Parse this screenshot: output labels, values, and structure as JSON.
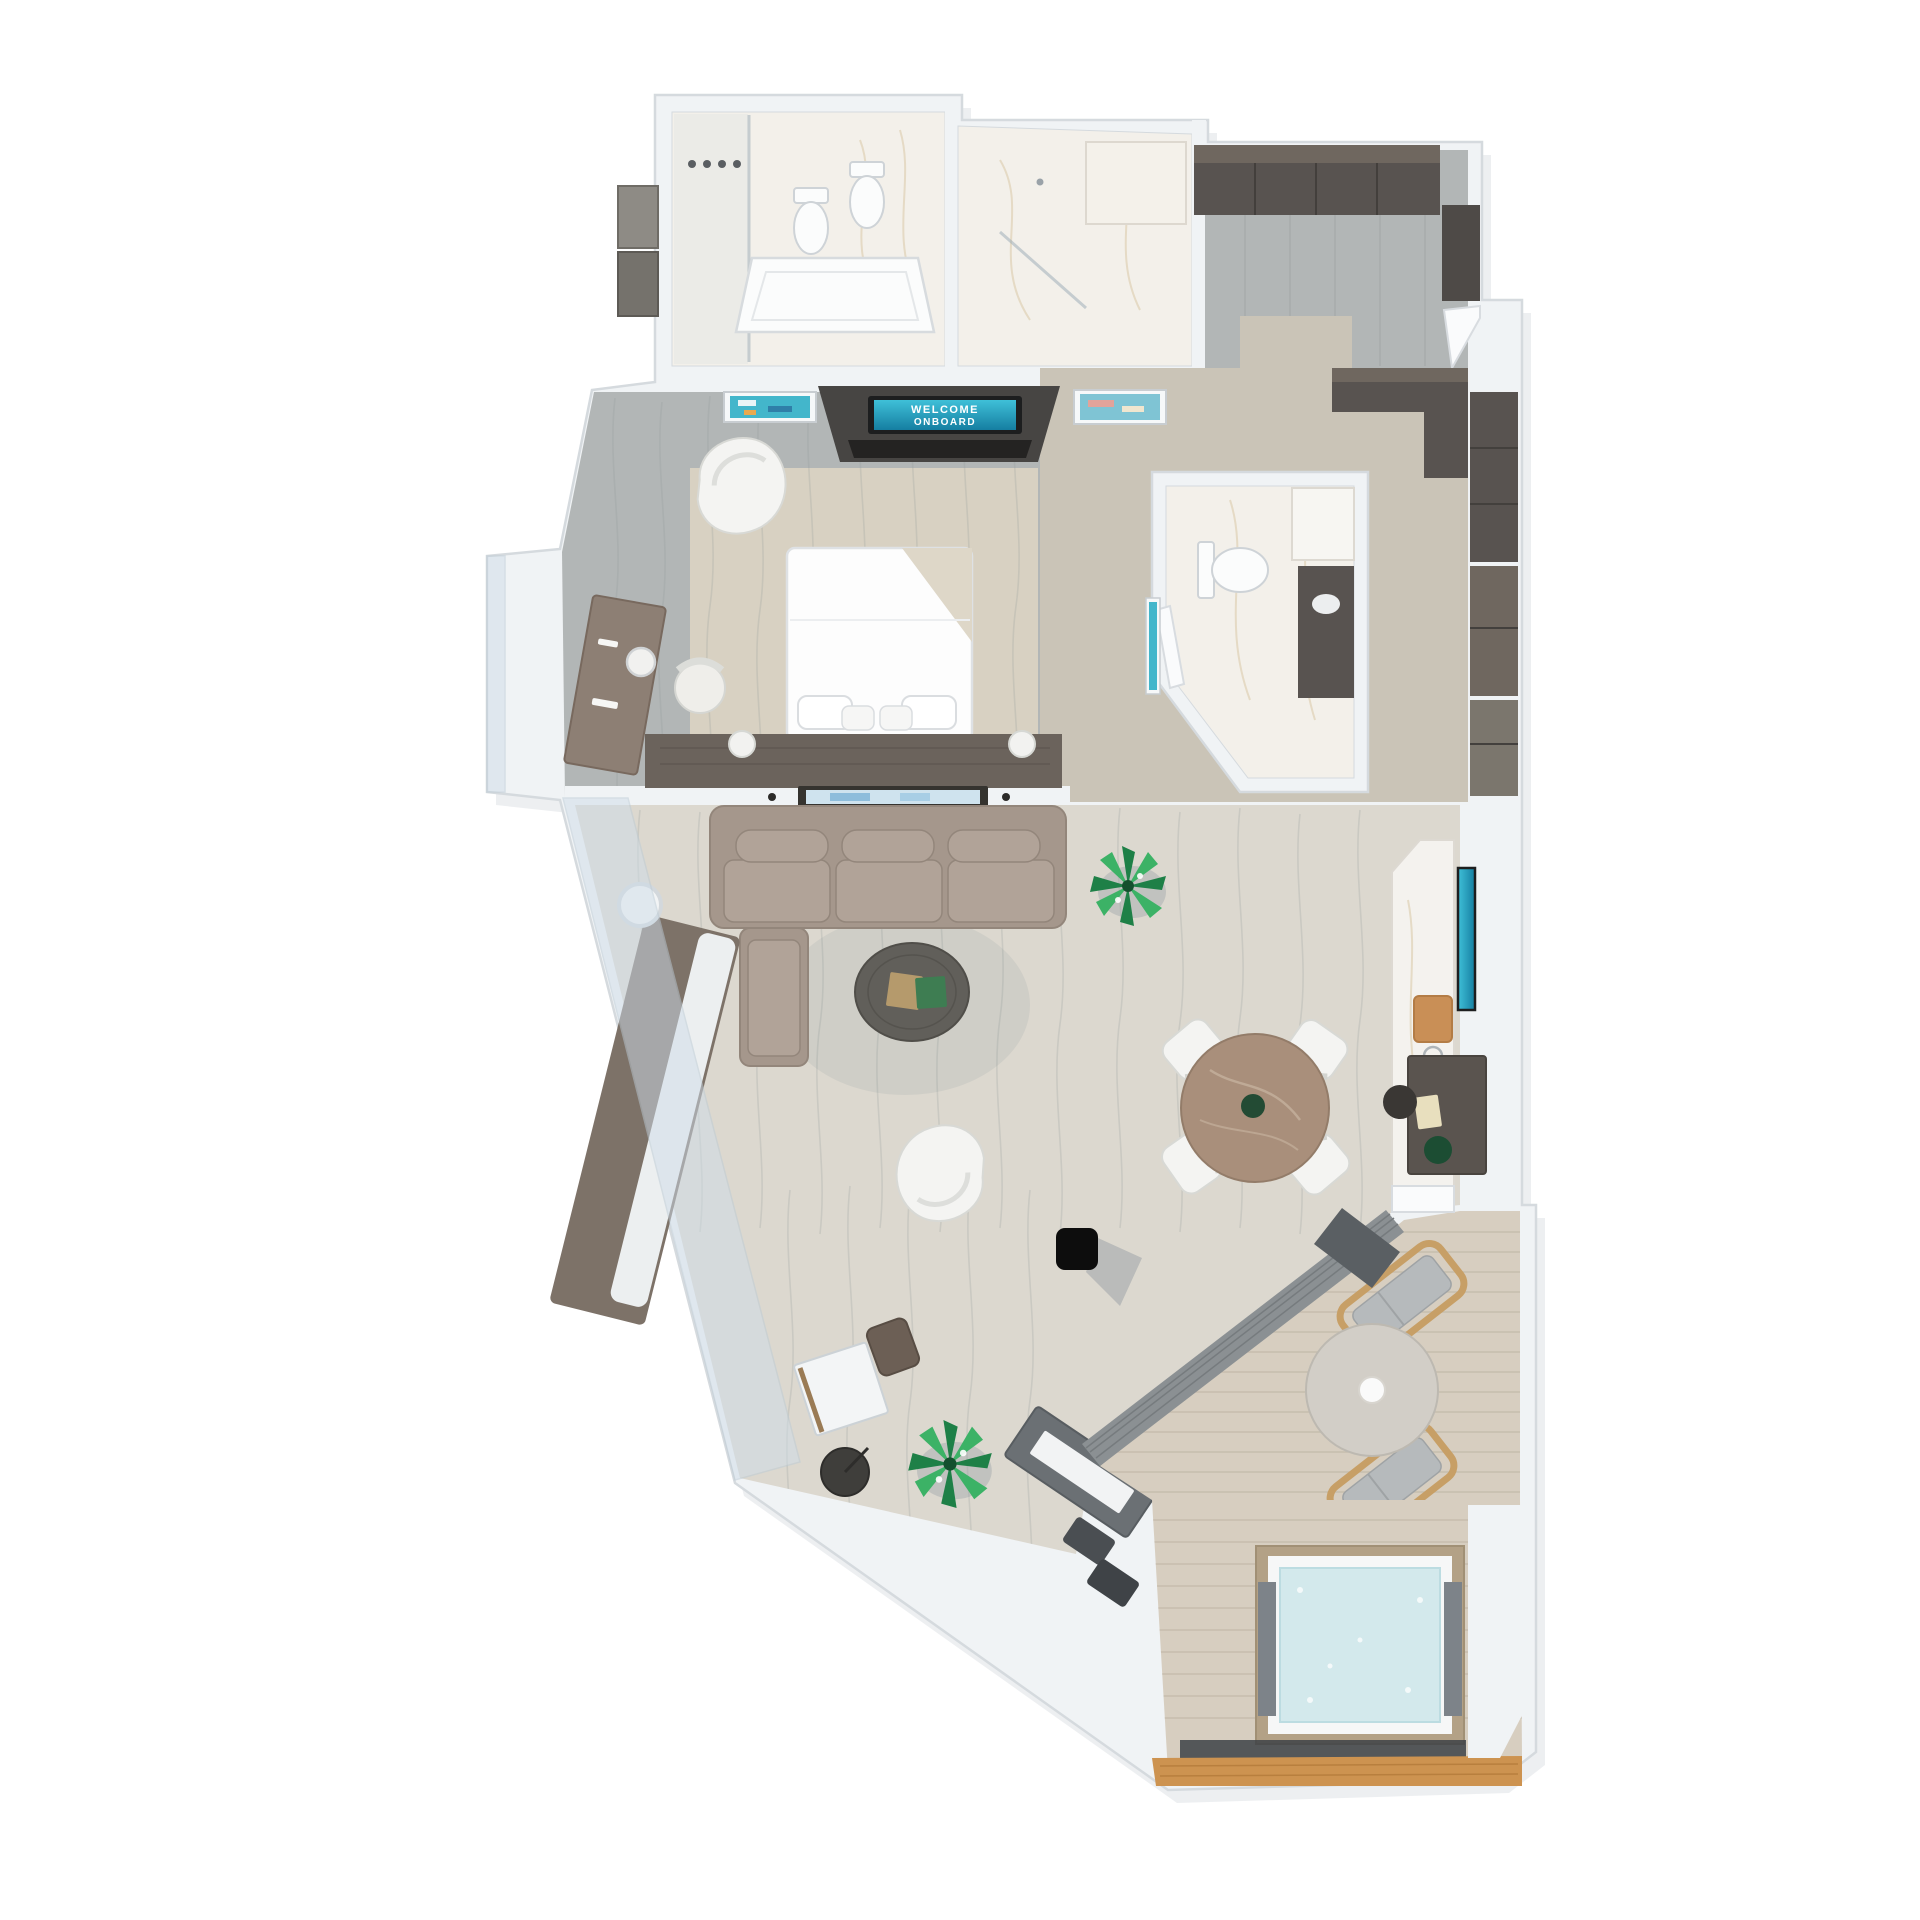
{
  "scene": {
    "type": "3d-floor-plan-top-down-render",
    "subject": "cruise-ship-suite-with-balcony-and-hot-tub",
    "tv_screen": {
      "line1": "WELCOME",
      "line2": "ONBOARD"
    },
    "rooms": [
      "master-bathroom",
      "walk-in-shower",
      "entry-hall",
      "wardrobe",
      "bedroom",
      "guest-bathroom",
      "hallway-closet",
      "living-room",
      "dining-area",
      "bar-counter",
      "balcony",
      "hot-tub-deck"
    ],
    "furniture": [
      "bathtub",
      "toilet",
      "bidet",
      "shower-heads",
      "vanity-cabinets",
      "king-bed",
      "pillows",
      "headboard",
      "bedroom-tv",
      "artworks",
      "organic-armchair",
      "vanity-desk",
      "desk-chair",
      "round-mirror",
      "sectional-sofa",
      "chaise",
      "coffee-table",
      "books",
      "floor-plants",
      "lounge-chair",
      "black-ottoman",
      "dining-table",
      "dining-chairs",
      "bar-tv",
      "cutting-board",
      "writing-desk",
      "side-table",
      "floor-lamp",
      "sideboard",
      "window-bench",
      "balcony-table",
      "sun-loungers",
      "hot-tub",
      "deck-planks"
    ]
  },
  "colors": {
    "bg": "#ffffff",
    "wall": "#f0f3f5",
    "wall-edge": "#d5dade",
    "wall-shadow": "#c2cad1",
    "marble": "#f3f0ea",
    "marble2": "#ece7df",
    "marble-vein": "#d9c8a6",
    "gray-wood-floor": "#b2b6b6",
    "beige-floor": "#cac4b7",
    "rug": "#d8d1c2",
    "living-floor": "#dcd8cf",
    "floor-line": "#8e9494",
    "wood-dark": "#585350",
    "wood-mid": "#6f675f",
    "headboard": "#6b635c",
    "sofa": "#a5978c",
    "sofa-cushion": "#b1a398",
    "sofa-edge": "#93867b",
    "white-furn": "#f4f4f2",
    "furn-edge": "#d8d9d5",
    "screen-teal": "#3fc0d8",
    "screen-teal-dark": "#157ea1",
    "art-teal": "#43b6cb",
    "coffee-table": "#615f5a",
    "dining-table": "#a98f7b",
    "plant-dark": "#1e8047",
    "plant-light": "#3cb266",
    "balcony-partition": "#8b9093",
    "deck": "#d7cec0",
    "deck-line": "#c3b9a9",
    "stone-table": "#d2cec7",
    "lounger-wood": "#c79f66",
    "lounger-cushion": "#b6babc",
    "tub-wood": "#b3a186",
    "water": "#d3e9ec",
    "panel-gray": "#7d8389",
    "edge-wood": "#cd9350",
    "black": "#0d0d0d",
    "glass": "#cfdde9"
  }
}
